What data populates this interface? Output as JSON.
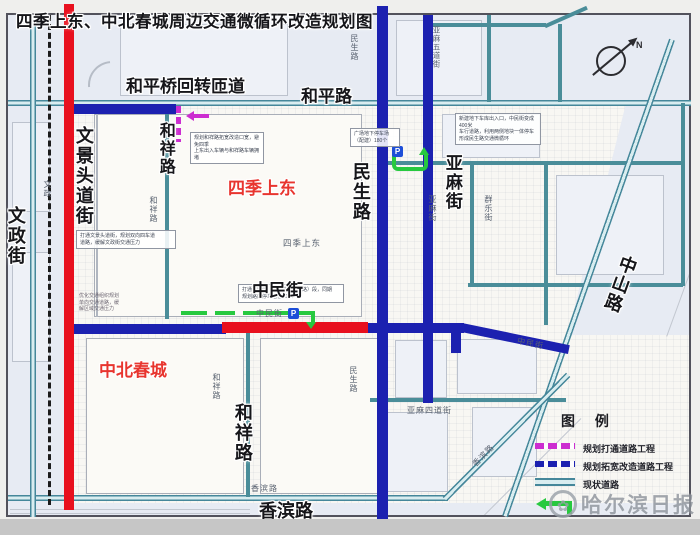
{
  "title": "四季上东、中北春城周边交通微循环改造规划图",
  "compass": {
    "north": "N"
  },
  "parking_icon": "P",
  "watermark": {
    "name": "哈尔滨日报",
    "logo": "✿"
  },
  "legend": {
    "title": "图 例",
    "items": [
      {
        "label": "规划打通道路工程",
        "color": "#cc2dd0",
        "style": "dashed"
      },
      {
        "label": "规划拓宽改造道路工程",
        "color": "#1c21b0",
        "style": "dashed"
      },
      {
        "label": "现状道路",
        "color": "#4a8d99",
        "style": "double-line"
      },
      {
        "label": "",
        "color": "#27c93f",
        "style": "arrow"
      }
    ]
  },
  "area_labels": [
    {
      "text": "四季上东"
    },
    {
      "text": "中北春城"
    }
  ],
  "road_labels": [
    {
      "text": "和平桥回转匝道"
    },
    {
      "text": "和平路"
    },
    {
      "text": "文政街"
    },
    {
      "text": "文景头道街"
    },
    {
      "text": "和祥路"
    },
    {
      "text": "民生路"
    },
    {
      "text": "亚麻街"
    },
    {
      "text": "中山路"
    },
    {
      "text": "中民街"
    },
    {
      "text": "和祥路"
    },
    {
      "text": "香滨路"
    }
  ],
  "minor_labels": [
    {
      "text": "文政"
    },
    {
      "text": "和祥路"
    },
    {
      "text": "民生路"
    },
    {
      "text": "民生路"
    },
    {
      "text": "四季上东"
    },
    {
      "text": "中民街"
    },
    {
      "text": "亚麻五道街"
    },
    {
      "text": "亚麻街"
    },
    {
      "text": "群乐街"
    },
    {
      "text": "亚麻四道街"
    },
    {
      "text": "香滨路"
    },
    {
      "text": "香滨路"
    },
    {
      "text": "中民街"
    },
    {
      "text": "和祥路"
    }
  ],
  "annotations": [
    {
      "text": "新建地下车库出入口，中民街变成400米\n车行道路，利用两侧地块一体停车\n形成民生路交通微循环"
    },
    {
      "text": "规划和祥路拓宽改造口宽，避免四季\n上东出入车辆与和祥路车辆拥堵"
    },
    {
      "text": "打通文景头道街，规划双向四车道\n道路，缓解文政街交通压力"
    },
    {
      "text": "优化交通组织规划\n单向交通道路，缓\n解区域交通压力"
    },
    {
      "text": "打通中民街（和祥路—民生路）段，同期\n规划路内停车泊位300个"
    },
    {
      "text": "广场地下停车场\n（配建）180个"
    }
  ],
  "colors": {
    "planned_open": "#cc2dd0",
    "planned_widen": "#1c21b0",
    "existing_road": "#4a8d99",
    "highlight_red": "#e8101e",
    "flow_green": "#27c93f"
  }
}
